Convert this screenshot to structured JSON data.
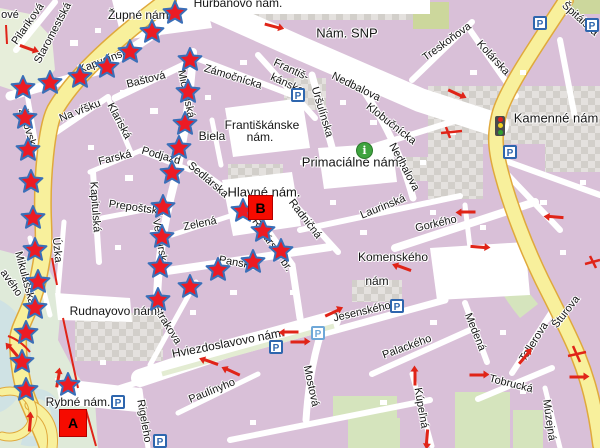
{
  "map": {
    "description": "Bratislava old town street map with starred walking route between markers A and B",
    "colors": {
      "block": "#d9c0d8",
      "street": "#ffffff",
      "road_fill": "#f8f09c",
      "road_edge": "#e0a93c",
      "green": "#d5e4bd",
      "olive": "#ccd79c",
      "park": "#dfead9",
      "water": "#cfe2e4",
      "checker_light": "#e4e1de",
      "checker_dark": "#d2cfca",
      "label": "#151515",
      "star_fill": "#ec1b24",
      "star_edge": "#3a6fb8",
      "marker_fill": "#f60b00",
      "arrow": "#e02418",
      "parking_blue": "#2e66ae",
      "info_green": "#3fa33f"
    },
    "labels": [
      {
        "t": "Hurbanovo nám.",
        "x": 238,
        "y": 3,
        "r": 0,
        "s": 12
      },
      {
        "t": "Župné nám.",
        "x": 140,
        "y": 15,
        "r": 0,
        "s": 12
      },
      {
        "t": "Nám. SNP",
        "x": 347,
        "y": 33,
        "r": 0,
        "s": 13
      },
      {
        "t": "ové",
        "x": 10,
        "y": 15,
        "r": 0,
        "s": 11
      },
      {
        "t": "Pilariková",
        "x": 28,
        "y": 24,
        "r": -55,
        "s": 11
      },
      {
        "t": "Staromestská",
        "x": 53,
        "y": 33,
        "r": -62,
        "s": 11
      },
      {
        "t": "Kapucínska",
        "x": 106,
        "y": 60,
        "r": -21,
        "s": 11
      },
      {
        "t": "Baštová",
        "x": 146,
        "y": 80,
        "r": -14,
        "s": 11
      },
      {
        "t": "Zámočnícka",
        "x": 233,
        "y": 77,
        "r": 17,
        "s": 11
      },
      {
        "t": "Františ-",
        "x": 291,
        "y": 70,
        "r": 25,
        "s": 11
      },
      {
        "t": "kánska",
        "x": 287,
        "y": 84,
        "r": 25,
        "s": 11
      },
      {
        "t": "Uršulínska",
        "x": 322,
        "y": 112,
        "r": 73,
        "s": 11
      },
      {
        "t": "Nedbalova",
        "x": 356,
        "y": 87,
        "r": 26,
        "s": 11
      },
      {
        "t": "Klobučnícka",
        "x": 391,
        "y": 124,
        "r": 38,
        "s": 11
      },
      {
        "t": "Nedbalova",
        "x": 404,
        "y": 167,
        "r": 62,
        "s": 11
      },
      {
        "t": "Treskoňova",
        "x": 447,
        "y": 42,
        "r": -36,
        "s": 11
      },
      {
        "t": "Kolárska",
        "x": 493,
        "y": 58,
        "r": 47,
        "s": 11
      },
      {
        "t": "Špitálska",
        "x": 580,
        "y": 19,
        "r": 42,
        "s": 11
      },
      {
        "t": "Kamenné nám",
        "x": 556,
        "y": 118,
        "r": 0,
        "s": 13
      },
      {
        "t": "Na vŕšku",
        "x": 80,
        "y": 111,
        "r": -22,
        "s": 11
      },
      {
        "t": "Klariská",
        "x": 119,
        "y": 121,
        "r": 62,
        "s": 11
      },
      {
        "t": "Michalská",
        "x": 186,
        "y": 94,
        "r": 78,
        "s": 11
      },
      {
        "t": "Biela",
        "x": 212,
        "y": 136,
        "r": 0,
        "s": 12
      },
      {
        "t": "Františkánske",
        "x": 262,
        "y": 125,
        "r": 0,
        "s": 12
      },
      {
        "t": "nám.",
        "x": 260,
        "y": 137,
        "r": 0,
        "s": 12
      },
      {
        "t": "Farská",
        "x": 115,
        "y": 158,
        "r": -14,
        "s": 11
      },
      {
        "t": "Podjazd",
        "x": 161,
        "y": 156,
        "r": 16,
        "s": 11
      },
      {
        "t": "Sedlárska",
        "x": 208,
        "y": 180,
        "r": 40,
        "s": 11
      },
      {
        "t": "Kapitulská",
        "x": 95,
        "y": 207,
        "r": 86,
        "s": 11
      },
      {
        "t": "Prepoštská",
        "x": 136,
        "y": 208,
        "r": 8,
        "s": 11
      },
      {
        "t": "Zelená",
        "x": 200,
        "y": 224,
        "r": -12,
        "s": 11
      },
      {
        "t": "Ventúrska",
        "x": 160,
        "y": 243,
        "r": 80,
        "s": 11
      },
      {
        "t": "Úzka",
        "x": 57,
        "y": 250,
        "r": 84,
        "s": 11
      },
      {
        "t": "Mikulášska",
        "x": 25,
        "y": 278,
        "r": 75,
        "s": 11
      },
      {
        "t": "Židovská",
        "x": 28,
        "y": 130,
        "r": 73,
        "s": 11
      },
      {
        "t": "avého",
        "x": 11,
        "y": 283,
        "r": 55,
        "s": 11
      },
      {
        "t": "Primaciálne nám.",
        "x": 352,
        "y": 162,
        "r": 0,
        "s": 13
      },
      {
        "t": "Hlavné nám.",
        "x": 264,
        "y": 192,
        "r": 0,
        "s": 13
      },
      {
        "t": "Radničná",
        "x": 305,
        "y": 219,
        "r": 52,
        "s": 11
      },
      {
        "t": "Laurinská",
        "x": 383,
        "y": 207,
        "r": -22,
        "s": 11
      },
      {
        "t": "Gorkého",
        "x": 436,
        "y": 224,
        "r": -13,
        "s": 11
      },
      {
        "t": "Komenského",
        "x": 393,
        "y": 257,
        "r": 0,
        "s": 12
      },
      {
        "t": "nám",
        "x": 377,
        "y": 281,
        "r": 0,
        "s": 12
      },
      {
        "t": "Jesenského",
        "x": 362,
        "y": 312,
        "r": -13,
        "s": 11
      },
      {
        "t": "Panská",
        "x": 237,
        "y": 263,
        "r": 10,
        "s": 11
      },
      {
        "t": "Rybárska br.",
        "x": 272,
        "y": 245,
        "r": 55,
        "s": 11
      },
      {
        "t": "Strakova",
        "x": 167,
        "y": 325,
        "r": 58,
        "s": 11
      },
      {
        "t": "Rudnayovo nám.",
        "x": 115,
        "y": 311,
        "r": 0,
        "s": 12
      },
      {
        "t": "Hviezdoslavovo nám.",
        "x": 228,
        "y": 343,
        "r": -11,
        "s": 12
      },
      {
        "t": "Rybné nám.",
        "x": 78,
        "y": 402,
        "r": 0,
        "s": 12
      },
      {
        "t": "Rigeleho",
        "x": 144,
        "y": 421,
        "r": 80,
        "s": 11
      },
      {
        "t": "Paulínyho",
        "x": 212,
        "y": 391,
        "r": -22,
        "s": 11
      },
      {
        "t": "Mostová",
        "x": 311,
        "y": 386,
        "r": 78,
        "s": 11
      },
      {
        "t": "Palackého",
        "x": 407,
        "y": 347,
        "r": -20,
        "s": 11
      },
      {
        "t": "Kúpeľná",
        "x": 421,
        "y": 408,
        "r": 80,
        "s": 11
      },
      {
        "t": "Medená",
        "x": 475,
        "y": 332,
        "r": 68,
        "s": 11
      },
      {
        "t": "Tobrucká",
        "x": 511,
        "y": 384,
        "r": 14,
        "s": 11
      },
      {
        "t": "Tallerova",
        "x": 534,
        "y": 342,
        "r": -58,
        "s": 11
      },
      {
        "t": "Šturova",
        "x": 566,
        "y": 312,
        "r": -52,
        "s": 11
      },
      {
        "t": "Múzejná",
        "x": 549,
        "y": 420,
        "r": 82,
        "s": 11
      }
    ],
    "stars": [
      [
        23,
        88
      ],
      [
        50,
        83
      ],
      [
        80,
        77
      ],
      [
        107,
        67
      ],
      [
        130,
        52
      ],
      [
        152,
        32
      ],
      [
        175,
        13
      ],
      [
        25,
        118
      ],
      [
        28,
        150
      ],
      [
        31,
        182
      ],
      [
        33,
        218
      ],
      [
        35,
        250
      ],
      [
        38,
        282
      ],
      [
        35,
        308
      ],
      [
        26,
        333
      ],
      [
        22,
        362
      ],
      [
        26,
        390
      ],
      [
        68,
        385
      ],
      [
        190,
        60
      ],
      [
        188,
        92
      ],
      [
        185,
        124
      ],
      [
        179,
        148
      ],
      [
        172,
        173
      ],
      [
        163,
        207
      ],
      [
        162,
        237
      ],
      [
        160,
        267
      ],
      [
        243,
        211
      ],
      [
        263,
        231
      ],
      [
        281,
        251
      ],
      [
        253,
        262
      ],
      [
        218,
        270
      ],
      [
        190,
        287
      ],
      [
        158,
        300
      ]
    ],
    "markers": [
      {
        "label": "A",
        "x": 59,
        "y": 409,
        "size": 28
      },
      {
        "label": "B",
        "x": 248,
        "y": 195,
        "size": 25
      }
    ],
    "parking": [
      {
        "x": 298,
        "y": 95
      },
      {
        "x": 540,
        "y": 23
      },
      {
        "x": 592,
        "y": 25
      },
      {
        "x": 510,
        "y": 152
      },
      {
        "x": 318,
        "y": 333,
        "light": true
      },
      {
        "x": 276,
        "y": 347
      },
      {
        "x": 397,
        "y": 306
      },
      {
        "x": 118,
        "y": 402
      },
      {
        "x": 160,
        "y": 441
      }
    ],
    "parking_glyph": "P",
    "info_icon": {
      "x": 365,
      "y": 151,
      "glyph": "i"
    },
    "traffic_light_icon": {
      "x": 500,
      "y": 121
    },
    "arrows": [
      {
        "x": 27,
        "y": 48,
        "d": 20
      },
      {
        "x": 272,
        "y": 26,
        "d": 15
      },
      {
        "x": 455,
        "y": 93,
        "d": 25
      },
      {
        "x": 468,
        "y": 212,
        "d": 180
      },
      {
        "x": 478,
        "y": 247,
        "d": 5
      },
      {
        "x": 556,
        "y": 217,
        "d": 185
      },
      {
        "x": 404,
        "y": 268,
        "d": 200
      },
      {
        "x": 291,
        "y": 332,
        "d": 180
      },
      {
        "x": 298,
        "y": 342,
        "d": 0
      },
      {
        "x": 332,
        "y": 313,
        "d": -25
      },
      {
        "x": 211,
        "y": 362,
        "d": 200
      },
      {
        "x": 233,
        "y": 372,
        "d": 205
      },
      {
        "x": 477,
        "y": 375,
        "d": 0
      },
      {
        "x": 524,
        "y": 358,
        "d": -50
      },
      {
        "x": 415,
        "y": 378,
        "d": -90
      },
      {
        "x": 577,
        "y": 377,
        "d": 0
      },
      {
        "x": 427,
        "y": 437,
        "d": 95
      },
      {
        "x": 14,
        "y": 352,
        "d": 230
      },
      {
        "x": 58,
        "y": 380,
        "d": -80
      },
      {
        "x": 30,
        "y": 424,
        "d": -85
      }
    ]
  }
}
